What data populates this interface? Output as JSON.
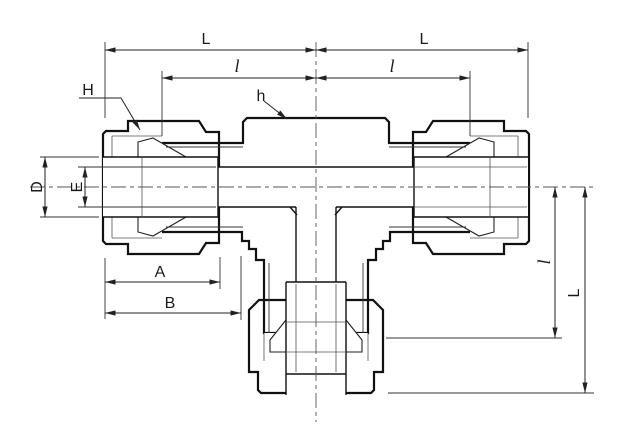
{
  "drawing": {
    "labels": {
      "dim_L_top_left": "L",
      "dim_L_top_right": "L",
      "dim_l_top_left": "l",
      "dim_l_top_right": "l",
      "dim_H": "H",
      "dim_h": "h",
      "dim_D": "D",
      "dim_E": "E",
      "dim_A": "A",
      "dim_B": "B",
      "dim_l_right_vertical": "l",
      "dim_L_right_vertical": "L"
    },
    "colors": {
      "background": "#ffffff",
      "outline": "#111111",
      "body_fill": "#eaeaea",
      "body_grid": "#cfcfcf",
      "nut_fill": "#d8d8d8",
      "nut_grid": "#b6b6b6",
      "dimension_line": "#222222",
      "centerline": "#555555"
    }
  }
}
